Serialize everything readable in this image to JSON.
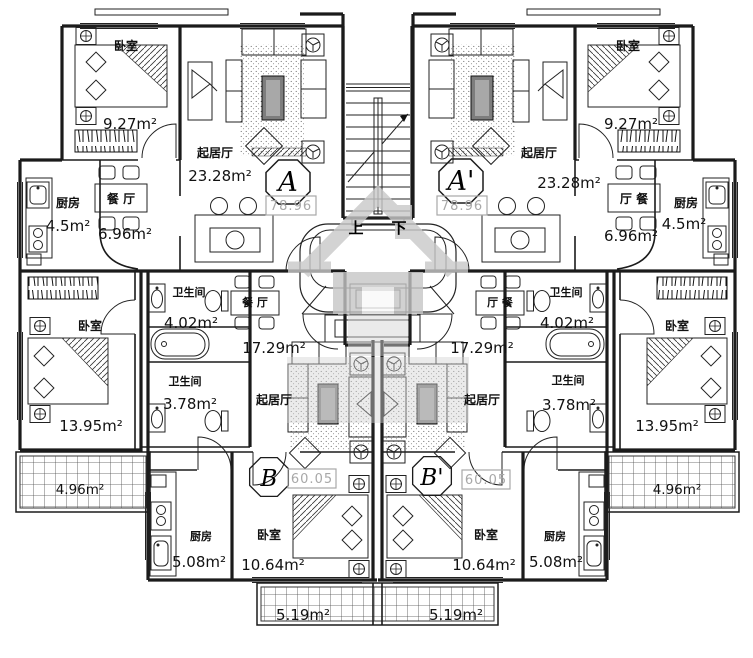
{
  "drawing": {
    "kind": "apartment-floor-plan",
    "language": "zh-CN",
    "watermark_icon": "house-logo",
    "stair": {
      "up": "上",
      "down": "下"
    },
    "labels": {
      "bedroom": "卧室",
      "living_room": "起居厅",
      "dining_room": "餐 厅",
      "dining_room_mirrored": "厅 餐",
      "kitchen": "厨房",
      "bathroom": "卫生间"
    },
    "unit_tags": {
      "a": "A",
      "a_mirrored": "A'",
      "b": "B",
      "b_mirrored": "B'"
    },
    "unit_total_areas": {
      "a": "78.96",
      "b": "60.05"
    },
    "areas": {
      "a_bedroom": "9.27m²",
      "a_living": "23.28m²",
      "a_kitchen": "4.5m²",
      "a_dining": "6.96m²",
      "b_bathroom_main": "4.02m²",
      "b_bathroom_small": "3.78m²",
      "b_dining": "17.29m²",
      "side_bedroom": "13.95m²",
      "side_balcony": "4.96m²",
      "b_kitchen": "5.08m²",
      "b_bedroom": "10.64m²",
      "bottom_balcony": "5.19m²"
    },
    "rooms": [
      {
        "unit": "A / A'",
        "name": "卧室",
        "area": "9.27m²"
      },
      {
        "unit": "A / A'",
        "name": "起居厅",
        "area": "23.28m²"
      },
      {
        "unit": "A / A'",
        "name": "厨房",
        "area": "4.5m²"
      },
      {
        "unit": "A / A'",
        "name": "餐厅",
        "area": "6.96m²"
      },
      {
        "unit": "A / A'",
        "name": "卧室",
        "area": "13.95m²"
      },
      {
        "unit": "A / A'",
        "name": "",
        "area": "4.96m²"
      },
      {
        "unit": "B / B'",
        "name": "卫生间",
        "area": "4.02m²"
      },
      {
        "unit": "B / B'",
        "name": "卫生间",
        "area": "3.78m²"
      },
      {
        "unit": "B / B'",
        "name": "餐厅",
        "area": "17.29m²"
      },
      {
        "unit": "B / B'",
        "name": "卧室",
        "area": "10.64m²"
      },
      {
        "unit": "B / B'",
        "name": "厨房",
        "area": "5.08m²"
      },
      {
        "unit": "B / B'",
        "name": "",
        "area": "5.19m²"
      }
    ],
    "colors": {
      "line": "#1b1b1b",
      "dim_gray": "#a8a8a8",
      "watermark": "#c9c9c9"
    }
  }
}
